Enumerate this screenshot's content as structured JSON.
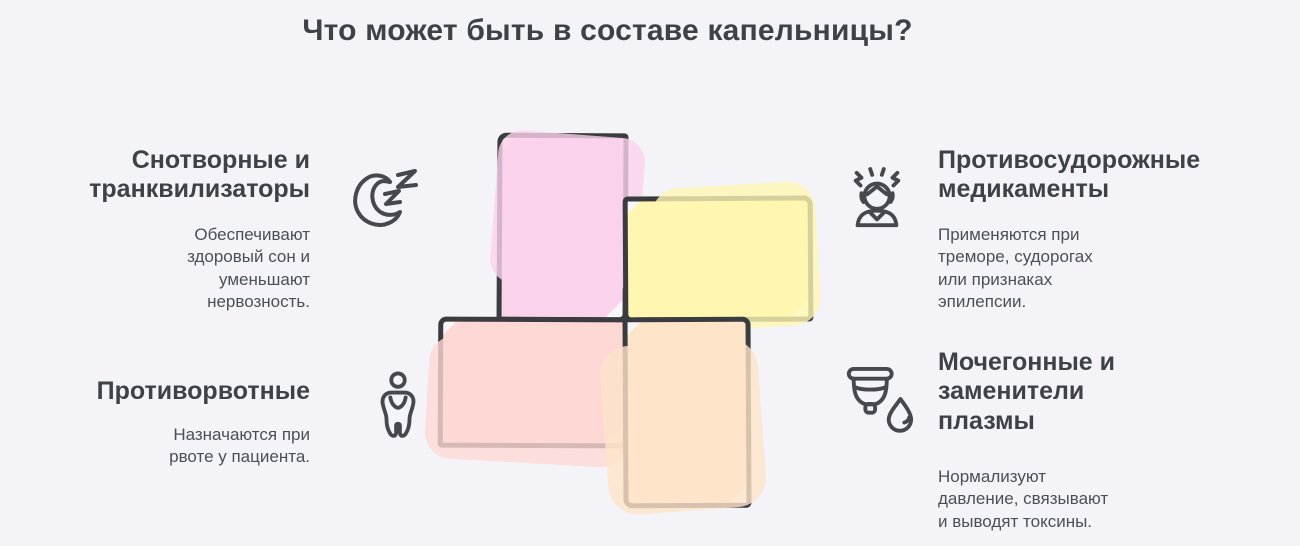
{
  "title": "Что может быть в составе капельницы?",
  "sections": {
    "sedatives": {
      "heading": "Снотворные и\nтранквилизаторы",
      "body": "Обеспечивают\nздоровый сон и\nуменьшают\nнервозность.",
      "icon": "sleep-moon-icon"
    },
    "antiemetics": {
      "heading": "Противорвотные",
      "body": "Назначаются при\nрвоте у пациента.",
      "icon": "nausea-person-icon"
    },
    "anticonvulsants": {
      "heading": "Противосудорожные\nмедикаменты",
      "body": "Применяются при\nтреморе, судорогах\nили признаках\nэпилепсии.",
      "icon": "tremor-person-icon"
    },
    "diuretics": {
      "heading": "Мочегонные и\nзаменители\nплазмы",
      "body": "Нормализуют\nдавление, связывают\nи выводят токсины.",
      "icon": "cup-drop-icon"
    }
  },
  "cross": {
    "outline_color": "#3B3C40",
    "squares": [
      {
        "name": "pink",
        "color": "#FBD2EB"
      },
      {
        "name": "yellow",
        "color": "#FEF6B1"
      },
      {
        "name": "salmon",
        "color": "#FED8D4"
      },
      {
        "name": "orange",
        "color": "#FEE4C9"
      }
    ]
  },
  "colors": {
    "background": "#F4F4F8",
    "heading_text": "#3E4247",
    "body_text": "#4B4F55",
    "icon_stroke": "#47484D"
  }
}
